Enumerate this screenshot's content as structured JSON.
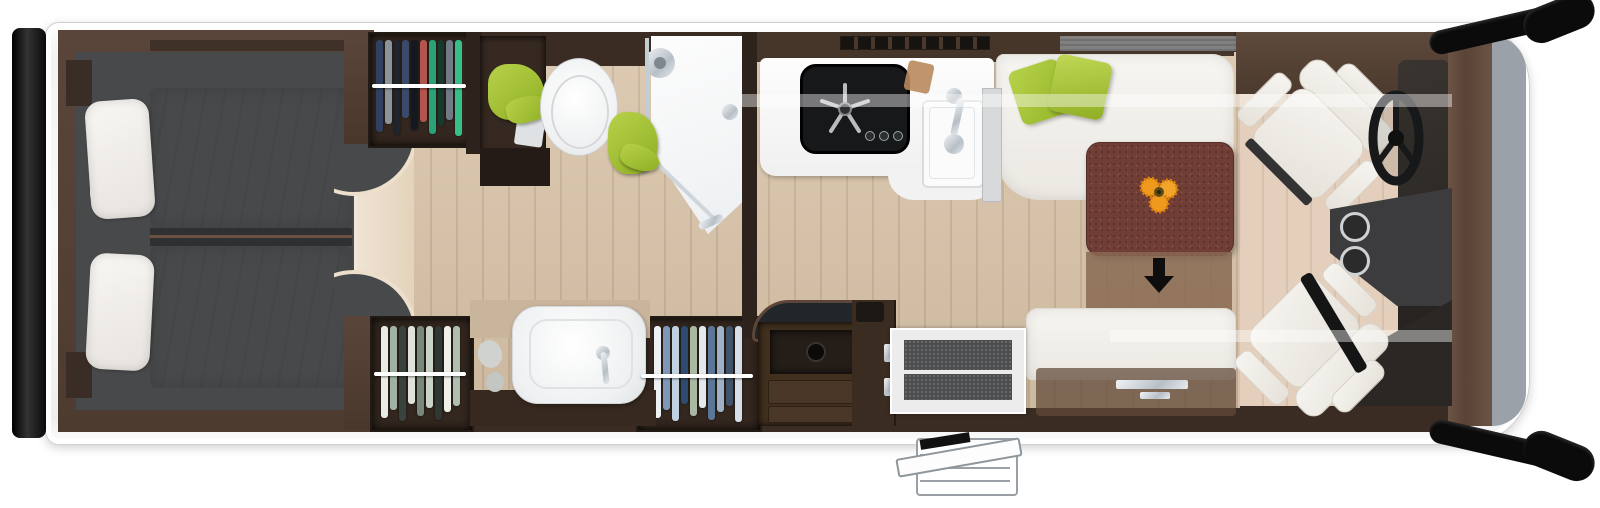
{
  "meta": {
    "title": "Motorhome floor plan - top-down interior view",
    "view": "top-down cutaway render",
    "orientation": "rear at left, driver cab at right",
    "visible_text": "none"
  },
  "palette": {
    "body_white": "#f7f7f7",
    "wall_wood_dark": "#3a2c22",
    "floor_oak": "#d9c4a9",
    "bedroom_floor_gray": "#47494b",
    "accent_green": "#a5c435",
    "table_rust": "#713e36",
    "cab_windshield_gray": "#9aa1a9",
    "black_trim": "#0b0b0b",
    "chrome": "#c9ced3",
    "flower_orange": "#ef9a1d"
  },
  "zones": [
    {
      "id": "rear-bedroom",
      "label": "Rear bedroom with two single beds, white duvets and pillows, dark gray podium floor"
    },
    {
      "id": "bedroom-step",
      "label": "Curved wooden step platform between beds and corridor"
    },
    {
      "id": "wardrobe-top",
      "label": "Wardrobe with dark hanging clothes on white rail"
    },
    {
      "id": "bathroom",
      "label": "Washroom: cabinet with green towel, toilet, corner shower cabin with glass door and green towel"
    },
    {
      "id": "washbasin-area",
      "label": "Washbasin with chrome tap on dark counter (bottom side)"
    },
    {
      "id": "wardrobe-bottom-left",
      "label": "Wardrobe with light hanging clothes"
    },
    {
      "id": "wardrobe-bottom-mid",
      "label": "Wardrobe with white and blue hanging clothes"
    },
    {
      "id": "kitchen",
      "label": "Kitchen: white worktop, black hob with star burner grid and 3 knobs, square sink with chrome tap, vent grille in wall"
    },
    {
      "id": "drawer-unit",
      "label": "Dark wood cabinet with open recess and drawers, curved dark worktop"
    },
    {
      "id": "entrance",
      "label": "Entry door with two dark step mats and exterior folding step below body"
    },
    {
      "id": "dinette",
      "label": "L-shaped white bench with two green cushions, rust-brown sliding table with flowers, side bench opposite"
    },
    {
      "id": "cab",
      "label": "Driver cab: two white swivel captain seats, steering wheel, center console with two cup holders, dark dashboard, gray windshield strip, black side mirrors"
    }
  ],
  "wardrobes": [
    {
      "id": "top",
      "colors": [
        "#31405f",
        "#8b949c",
        "#20242c",
        "#3a4a6b",
        "#141820",
        "#b2554e",
        "#2aa177",
        "#183a2e",
        "#6f7a85",
        "#35c08a"
      ]
    },
    {
      "id": "bottom-left",
      "colors": [
        "#e9ece5",
        "#9fb2a4",
        "#39433d",
        "#dfe3da",
        "#76897c",
        "#c9d4c6",
        "#2e3833",
        "#eef0e9",
        "#aebfb0"
      ]
    },
    {
      "id": "bottom-mid",
      "colors": [
        "#eef1f3",
        "#7d97b8",
        "#c0d2e2",
        "#2e4a6e",
        "#a9b8a2",
        "#e4e9ee",
        "#5b7698",
        "#9fb3c8",
        "#41536b",
        "#d7dee6"
      ]
    }
  ],
  "garment_heights": [
    92,
    84,
    95,
    78,
    90,
    82,
    94,
    86,
    80,
    96,
    88
  ],
  "annotations": [
    {
      "id": "table-slide-arrow",
      "symbol": "down-arrow",
      "meaning": "table top slides toward side bench"
    }
  ],
  "counts": {
    "beds": 2,
    "seats_cab": 2,
    "green_cushions": 2,
    "step_mats": 2,
    "cup_holders": 2,
    "wardrobes": 3
  }
}
